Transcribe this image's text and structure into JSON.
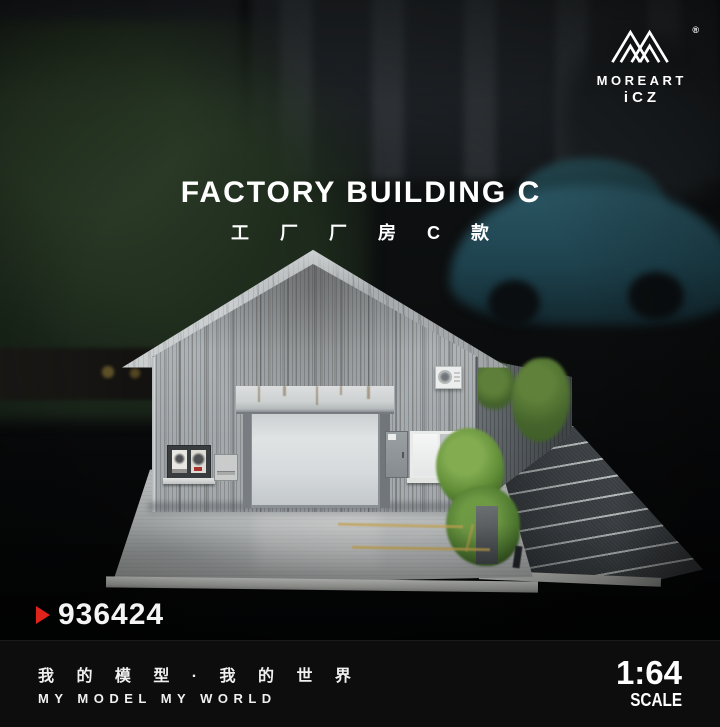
{
  "brand": {
    "name": "MOREART",
    "sub_brand": "iCZ",
    "registered": "®",
    "logo_icon": "double-mountain-monogram"
  },
  "title": {
    "en": "FACTORY BUILDING C",
    "cn": "工 厂 厂 房 C 款"
  },
  "product": {
    "number": "936424",
    "marker_icon": "red-right-triangle"
  },
  "footer": {
    "slogan_cn": "我 的 模 型 · 我 的 世 界",
    "slogan_en": "MY MODEL MY WORLD",
    "scale_value": "1:64",
    "scale_label": "SCALE"
  },
  "colors": {
    "accent_red": "#e0241c",
    "text_white": "#ffffff",
    "photo_background": "#0c0e0f",
    "footer_background": "#0d0d0e",
    "building_gray": "#a9aeb1",
    "roof_gray": "#b7bbbd",
    "door_gray": "#d6dadb",
    "asphalt_gray": "#43484c",
    "foliage_green": "#4e7a30",
    "car_teal": "#1e434f"
  },
  "scene": {
    "subject": "1:64 scale diorama model of a gray corrugated factory building photographed against a dark blurred street background",
    "elements": [
      "gable roof",
      "corrugated metal walls",
      "white roller shutter door",
      "door awning with rust streaks",
      "poster board with bench",
      "utility box",
      "electrical panel",
      "window with sill",
      "wall-mounted air conditioner",
      "green bushes and climbing vine",
      "parking lot with white bay lines",
      "light concrete display base"
    ],
    "background": [
      "building facade with windows",
      "dark trees",
      "teal sports car",
      "dark car silhouette"
    ],
    "parking_bay_lines": 8
  }
}
